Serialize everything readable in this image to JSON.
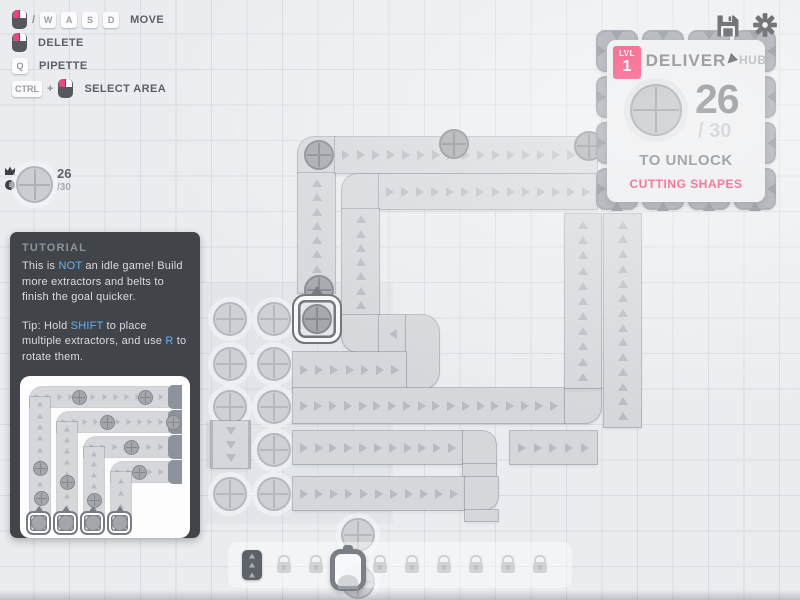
{
  "keybinds": {
    "slash": "/",
    "plus": "+",
    "wasd": [
      "W",
      "A",
      "S",
      "D"
    ],
    "move_label": "MOVE",
    "delete_label": "DELETE",
    "pipette_key": "Q",
    "pipette_label": "PIPETTE",
    "ctrl_key": "CTRL",
    "select_area_label": "SELECT AREA"
  },
  "goal_pin": {
    "count": "26",
    "total": "/30"
  },
  "hub": {
    "level_label": "LVL",
    "level": "1",
    "title": "DELIVER",
    "name": "HUB",
    "count": "26",
    "of_total": "/ 30",
    "unlock": "TO UNLOCK",
    "reward": "CUTTING SHAPES"
  },
  "tutorial": {
    "heading": "TUTORIAL",
    "p1": [
      "This is ",
      "NOT",
      " an idle game! Build more extractors and belts to finish the goal quicker."
    ],
    "p2": [
      "Tip: Hold ",
      "SHIFT",
      " to place multiple extractors, and use ",
      "R",
      " to rotate them."
    ]
  },
  "toolbar": {
    "slots": [
      {
        "type": "belt"
      },
      {
        "type": "lock"
      },
      {
        "type": "lock"
      },
      {
        "type": "extractor"
      },
      {
        "type": "lock"
      },
      {
        "type": "lock"
      },
      {
        "type": "lock"
      },
      {
        "type": "lock"
      },
      {
        "type": "lock"
      },
      {
        "type": "lock"
      }
    ]
  },
  "icons": {
    "save": "save-icon",
    "settings": "gear-icon",
    "hub_cursor": "cursor-icon",
    "crown": "crown-icon",
    "info": "info-icon",
    "mouse": "mouse-icon",
    "lock": "lock-icon"
  },
  "colors": {
    "accent_pink": "#f5215c",
    "highlight_blue": "#5fb2f1",
    "belt": "#d5d7db",
    "hub_building": "#959ba3",
    "map_bg": "#eaecef"
  }
}
